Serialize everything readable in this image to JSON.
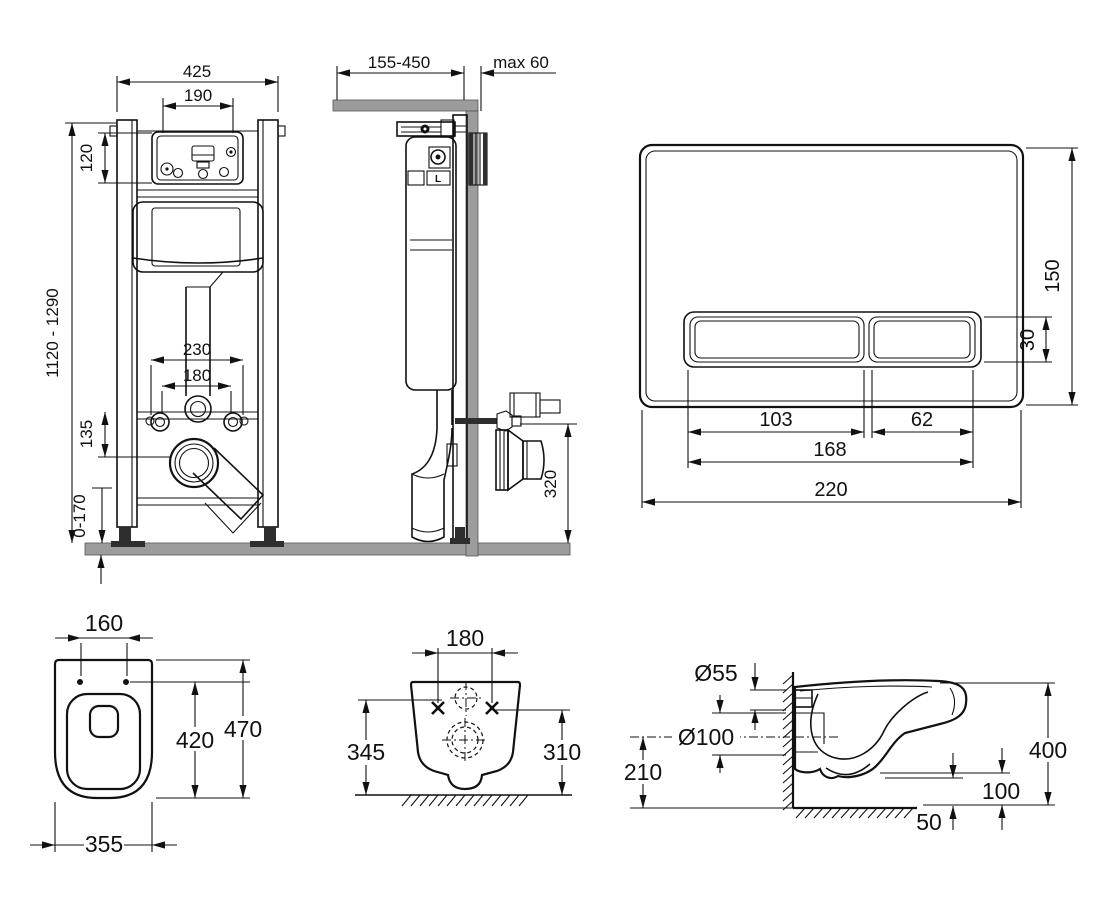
{
  "drawing": {
    "type": "wall-hung toilet installation set technical drawing",
    "line_color": "#111111",
    "masonry_color": "#9c9c9c"
  },
  "dims": {
    "frame_width": "425",
    "window_width": "190",
    "window_height": "120",
    "frame_height": "1120 - 1290",
    "fix_spacing_outer": "230",
    "fix_spacing_inner": "180",
    "fix_to_drain": "135",
    "feet_range": "0-170",
    "depth_range": "155-450",
    "wall_max": "max 60",
    "outlet_height": "320",
    "plate_height": "150",
    "button_height": "30",
    "button_left": "103",
    "button_right": "62",
    "buttons_width": "168",
    "plate_width": "220",
    "top_hole_spacing": "160",
    "top_inner_length": "420",
    "top_length": "470",
    "top_width": "355",
    "rear_hole_spacing": "180",
    "rear_height_left": "345",
    "rear_height_right": "310",
    "inlet_dia": "Ø55",
    "outlet_dia": "Ø100",
    "outlet_axis_height": "210",
    "side_height": "400",
    "bottom_clearance": "100",
    "trap_offset": "50",
    "cistern_mark": "L"
  }
}
